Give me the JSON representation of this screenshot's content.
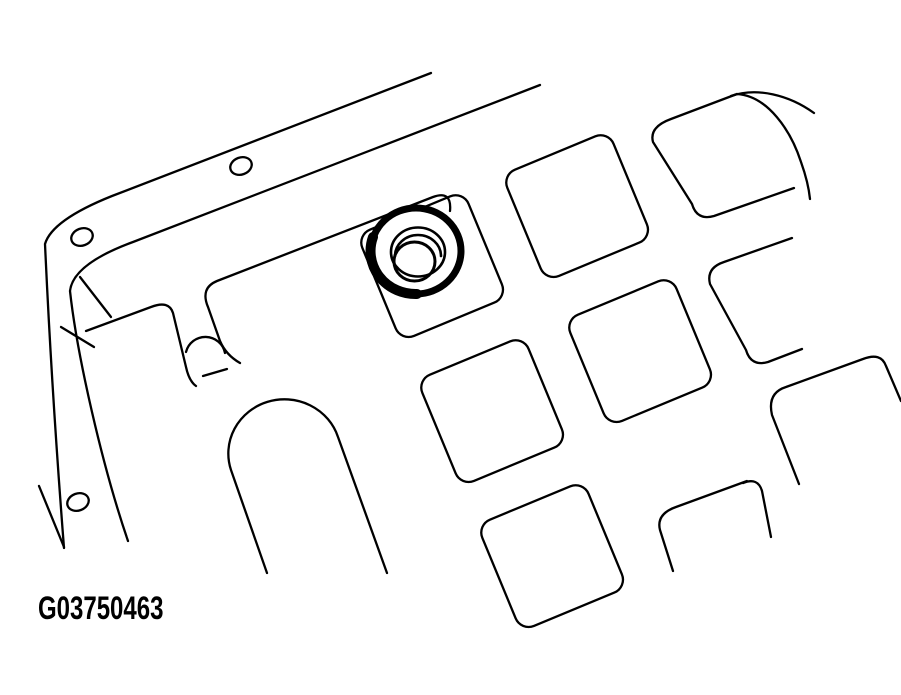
{
  "figure": {
    "label": "G03750463"
  },
  "colors": {
    "line": "#000000",
    "background": "#ffffff"
  },
  "drawing": {
    "kind": "line-art",
    "parts": [
      "pan-flange",
      "bolt-hole",
      "rib-grid-pocket",
      "pan-corner-boundary",
      "drain-plug-highlight",
      "arch-rib",
      "capsule-rib",
      "hatch-mark"
    ]
  }
}
